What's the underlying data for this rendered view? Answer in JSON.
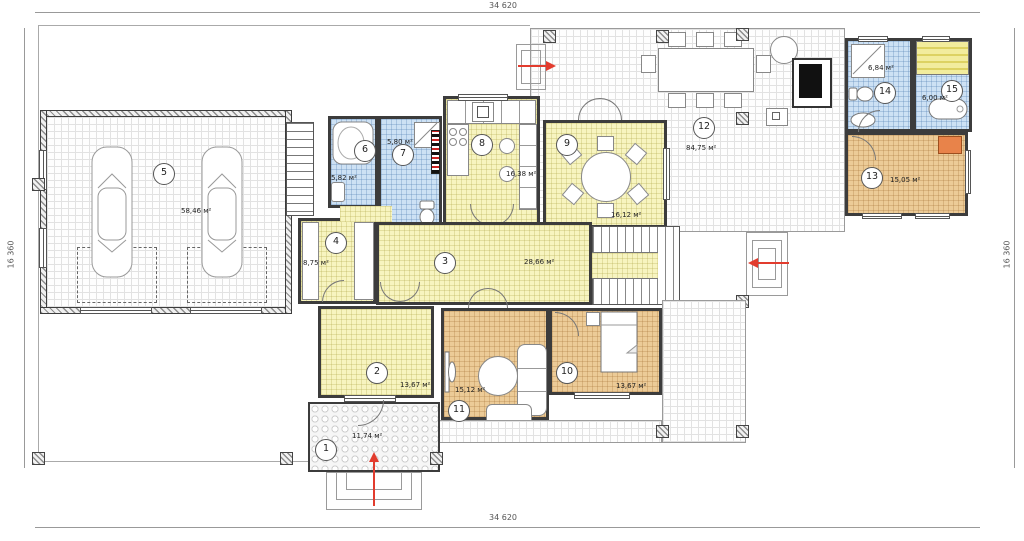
{
  "drawing": {
    "dim_top": "34 620",
    "dim_bottom": "34 620",
    "dim_left": "16 360",
    "dim_right": "16 360"
  },
  "rooms": [
    {
      "number": "1",
      "area": "11,74 м²"
    },
    {
      "number": "2",
      "area": "13,67 м²"
    },
    {
      "number": "3",
      "area": "28,66 м²"
    },
    {
      "number": "4",
      "area": "8,75 м²"
    },
    {
      "number": "5",
      "area": "58,46 м²"
    },
    {
      "number": "6",
      "area": "5,82 м²"
    },
    {
      "number": "7",
      "area": "5,80 м²"
    },
    {
      "number": "8",
      "area": "16,38 м²"
    },
    {
      "number": "9",
      "area": "16,12 м²"
    },
    {
      "number": "10",
      "area": "13,67 м²"
    },
    {
      "number": "11",
      "area": "15,12 м²"
    },
    {
      "number": "12",
      "area": "84,75 м²"
    },
    {
      "number": "13",
      "area": "15,05 м²"
    },
    {
      "number": "14",
      "area": "6,84 м²"
    },
    {
      "number": "15",
      "area": "6,00 м²"
    }
  ],
  "colors": {
    "wall": "#3c3c3c",
    "room_yellow": "#f7f4c0",
    "room_blue": "#cde1f4",
    "room_tan": "#eccb97",
    "accent_orange": "#e8834a",
    "arrow_red": "#e23c2e"
  }
}
